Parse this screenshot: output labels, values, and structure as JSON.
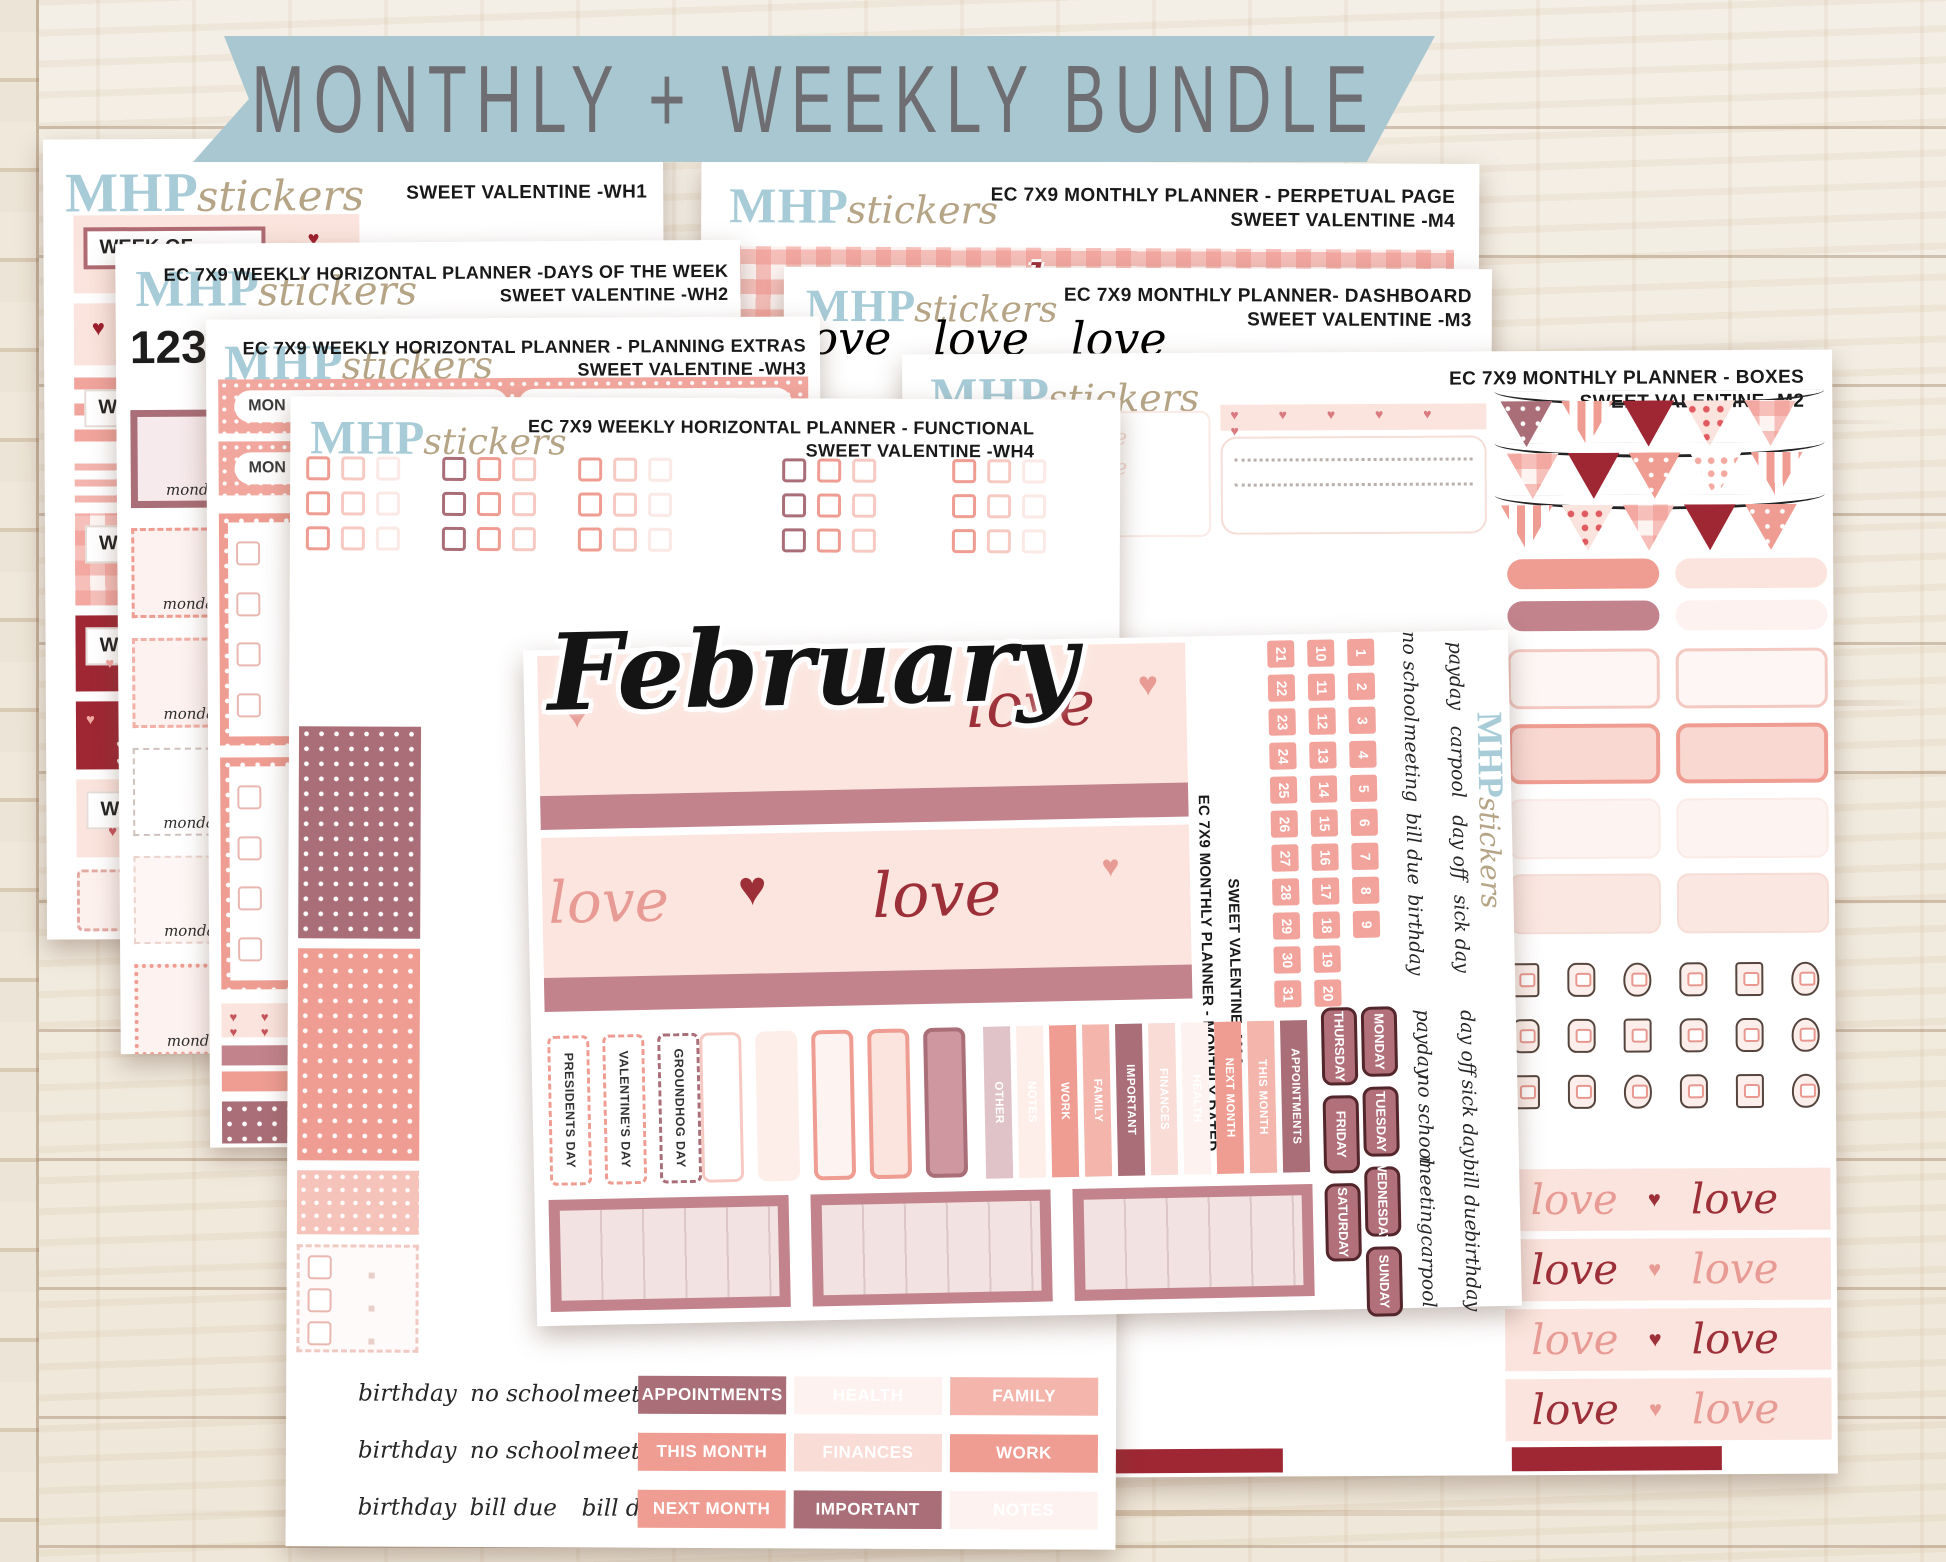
{
  "banner": {
    "title": "MONTHLY + WEEKLY BUNDLE"
  },
  "brand": {
    "bold": "MHP",
    "script": "stickers"
  },
  "glyphs": {
    "heart": "♥",
    "hearts_row": "♥ ♥ ♥ ♥ ♥ ♥",
    "love": "love",
    "love_line_faint": "love love love love"
  },
  "colors": {
    "ribbon": "#a9c7d0",
    "brand_blue": "#a7cbd7",
    "brand_tan": "#b5a486",
    "dark_red": "#9e2733",
    "mauve": "#c2838c",
    "salmon": "#ef9d92",
    "pale_pink": "#fbe4dd",
    "dark_mauve": "#a96e77"
  },
  "sheets": {
    "wh1": {
      "title2": "SWEET VALENTINE -WH1",
      "week_of": "WEEK OF"
    },
    "m4": {
      "title1": "EC 7X9 MONTHLY PLANNER - PERPETUAL PAGE",
      "title2": "SWEET VALENTINE -M4"
    },
    "wh2": {
      "title1": "EC 7X9 WEEKLY HORIZONTAL PLANNER -DAYS OF THE WEEK",
      "title2": "SWEET VALENTINE -WH2",
      "numbers": [
        "1",
        "2",
        "3",
        "4",
        "5",
        "6",
        "7",
        "8",
        "9",
        "10",
        "11",
        "12",
        "13",
        "14",
        "15",
        "16",
        "17",
        "18"
      ],
      "monday": "monday"
    },
    "m3": {
      "title1": "EC 7X9 MONTHLY PLANNER- DASHBOARD",
      "title2": "SWEET VALENTINE -M3",
      "love_words": [
        "love",
        "love",
        "love"
      ]
    },
    "wh3": {
      "title1": "EC 7X9 WEEKLY HORIZONTAL PLANNER - PLANNING EXTRAS",
      "title2": "SWEET VALENTINE -WH3",
      "mon": "MON"
    },
    "m2": {
      "title1": "EC 7X9 MONTHLY PLANNER - BOXES",
      "title2": "SWEET VALENTINE -M2",
      "icon_names": [
        "scissors",
        "piggy-bank",
        "tooth",
        "gas-pump",
        "stethoscope",
        "dumbbell",
        "washing-machine",
        "medicine-jar",
        "calculator",
        "suitcase",
        "envelope",
        "laundry-basket",
        "trash-can",
        "notebook",
        "gift-box",
        "shopping-cart",
        "calendar",
        "heart-card"
      ]
    },
    "wh4": {
      "title1": "EC 7X9 WEEKLY HORIZONTAL PLANNER - FUNCTIONAL",
      "title2": "SWEET VALENTINE -WH4",
      "words": [
        "birthday",
        "no school",
        "meeting",
        "payday",
        "birthday",
        "no school",
        "meeting",
        "payday",
        "birthday",
        "bill due",
        "bill due",
        "payday"
      ],
      "labels": [
        {
          "t": "APPOINTMENTS",
          "bg": "#a96e77",
          "fg": "#ffffff"
        },
        {
          "t": "HEALTH",
          "bg": "#fdf2ef",
          "fg": "#ffffff"
        },
        {
          "t": "FAMILY",
          "bg": "#f3b5ac",
          "fg": "#ffffff"
        },
        {
          "t": "THIS MONTH",
          "bg": "#ef9d92",
          "fg": "#ffffff"
        },
        {
          "t": "FINANCES",
          "bg": "#f9dcd6",
          "fg": "#ffffff"
        },
        {
          "t": "WORK",
          "bg": "#ef9d92",
          "fg": "#ffffff"
        },
        {
          "t": "NEXT MONTH",
          "bg": "#ef9d92",
          "fg": "#ffffff"
        },
        {
          "t": "IMPORTANT",
          "bg": "#a96e77",
          "fg": "#ffffff"
        },
        {
          "t": "NOTES",
          "bg": "#fdf2ef",
          "fg": "#ffffff"
        }
      ]
    },
    "m1a": {
      "title1": "EC 7X9 MONTHLY PLANNER - MONTHLY DATED",
      "title2": "SWEET VALENTINE -M1A",
      "month": "February",
      "dates_col1": [
        "21",
        "22",
        "23",
        "24",
        "25",
        "26",
        "27",
        "28",
        "29",
        "30",
        "31"
      ],
      "dates_col2": [
        "10",
        "11",
        "12",
        "13",
        "14",
        "15",
        "16",
        "17",
        "18",
        "19",
        "20"
      ],
      "dates_col3": [
        "1",
        "2",
        "3",
        "4",
        "5",
        "6",
        "7",
        "8",
        "9"
      ],
      "words_top_a": [
        "no school",
        "meeting",
        "bill due",
        "birthday"
      ],
      "words_top_b": [
        "payday",
        "carpool",
        "day off",
        "sick day"
      ],
      "words_bottom_a": [
        "payday",
        "no school",
        "meeting",
        "carpool"
      ],
      "words_bottom_b": [
        "day off",
        "sick day",
        "bill due",
        "birthday"
      ],
      "holidays": [
        "PRESIDENTS DAY",
        "VALENTINE'S DAY",
        "GROUNDHOG DAY"
      ],
      "labels": [
        {
          "t": "OTHER",
          "bg": "#dfc3c8",
          "fg": "#ffffff"
        },
        {
          "t": "NOTES",
          "bg": "#fdeeea",
          "fg": "#ffffff"
        },
        {
          "t": "WORK",
          "bg": "#ef9d92",
          "fg": "#ffffff"
        },
        {
          "t": "FAMILY",
          "bg": "#f3b5ac",
          "fg": "#ffffff"
        },
        {
          "t": "IMPORTANT",
          "bg": "#a96e77",
          "fg": "#ffffff"
        },
        {
          "t": "FINANCES",
          "bg": "#f9dcd6",
          "fg": "#ffffff"
        },
        {
          "t": "HEALTH",
          "bg": "#fdf2ef",
          "fg": "#ffffff"
        },
        {
          "t": "NEXT MONTH",
          "bg": "#ef9d92",
          "fg": "#ffffff"
        },
        {
          "t": "THIS MONTH",
          "bg": "#f3b5ac",
          "fg": "#ffffff"
        },
        {
          "t": "APPOINTMENTS",
          "bg": "#a96e77",
          "fg": "#ffffff"
        }
      ],
      "days_col1": [
        "THURSDAY",
        "FRIDAY",
        "SATURDAY"
      ],
      "days_col2": [
        "MONDAY",
        "TUESDAY",
        "WEDNESDAY",
        "SUNDAY"
      ]
    }
  }
}
